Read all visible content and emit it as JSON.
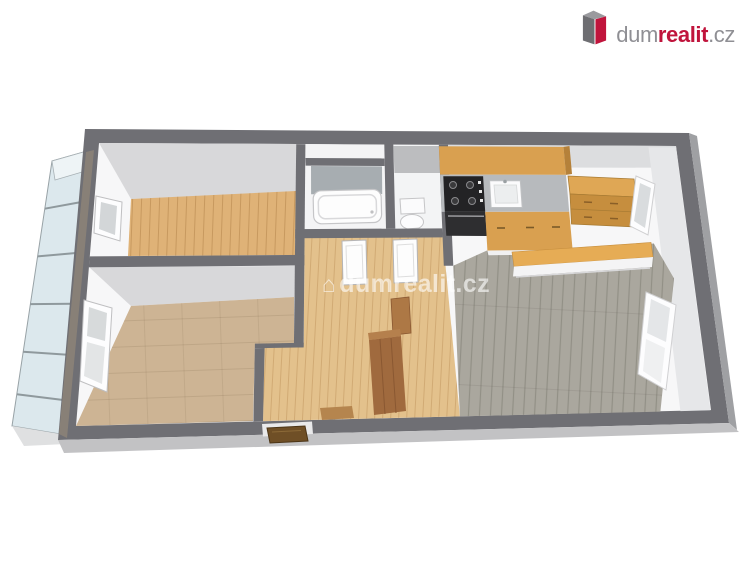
{
  "logo": {
    "prefix": "dum",
    "highlight": "realit",
    "suffix": ".cz",
    "icon": "dumrealit-3d-building-icon"
  },
  "watermark": {
    "text": "dumrealit.cz",
    "house_glyph": "⌂"
  },
  "colors": {
    "brand_red": "#c0143c",
    "brand_gray": "#8f8f94",
    "wall_dark": "#6f6f74",
    "wall_face_bottom": "#c2c2c4",
    "wall_face_right": "#9fa0a3",
    "interior_base": "#f7f7f8",
    "wood_floor": "#dfb277",
    "hall_floor": "#e3c18c",
    "carpet_floor": "#cdb494",
    "gray_wood_floor": "#aaa79e",
    "cabinet_wood": "#d9a050",
    "counter_gray": "#b7babd",
    "wardrobe_wood": "#a06a3e",
    "entrance_door_wood": "#6f4f26",
    "balcony_glass": "#dce8ed",
    "bath_tile": "#a7adb1"
  }
}
